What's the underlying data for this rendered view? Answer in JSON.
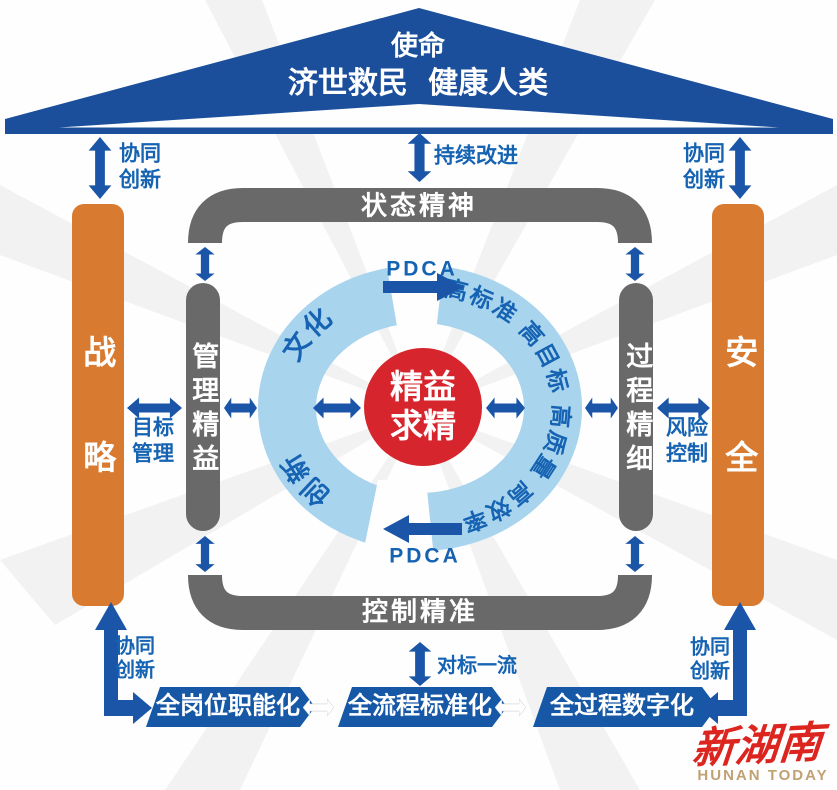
{
  "colors": {
    "roof_blue": "#1b4f9c",
    "frame_gray": "#696969",
    "pillar_orange": "#d87b31",
    "ring_blue": "#a9d4ee",
    "core_red": "#d6252c",
    "arrow_blue": "#1a55a8",
    "text_blue": "#1563b2",
    "banner_blue": "#1657a6",
    "logo_red": "#dc251f",
    "logo_gold": "#bfa172"
  },
  "roof": {
    "mission_label": "使命",
    "mission_text": "济世救民 健康人类"
  },
  "top": {
    "collab_left": "协同创新",
    "continuous_improvement": "持续改进",
    "collab_right": "协同创新"
  },
  "frame": {
    "top": "状态精神",
    "bottom": "控制精准",
    "left": "管理精益",
    "right": "过程精细"
  },
  "pillars": {
    "left": "战略",
    "right": "安全"
  },
  "links": {
    "goal_management": "目标管理",
    "risk_control": "风险控制",
    "benchmark": "对标一流",
    "pdca_top": "PDCA",
    "pdca_bottom": "PDCA"
  },
  "ring": {
    "right_text": "高标准 高目标 高质量 高效率",
    "left_upper": "文化",
    "left_lower": "创新"
  },
  "core": {
    "text": "精益求精"
  },
  "banners": [
    {
      "label": "全岗位职能化"
    },
    {
      "label": "全流程标准化"
    },
    {
      "label": "全过程数字化"
    }
  ],
  "bottom": {
    "collab_left": "协同创新",
    "collab_right": "协同创新"
  },
  "logo": {
    "name": "新湖南",
    "tagline": "HUNAN TODAY"
  }
}
